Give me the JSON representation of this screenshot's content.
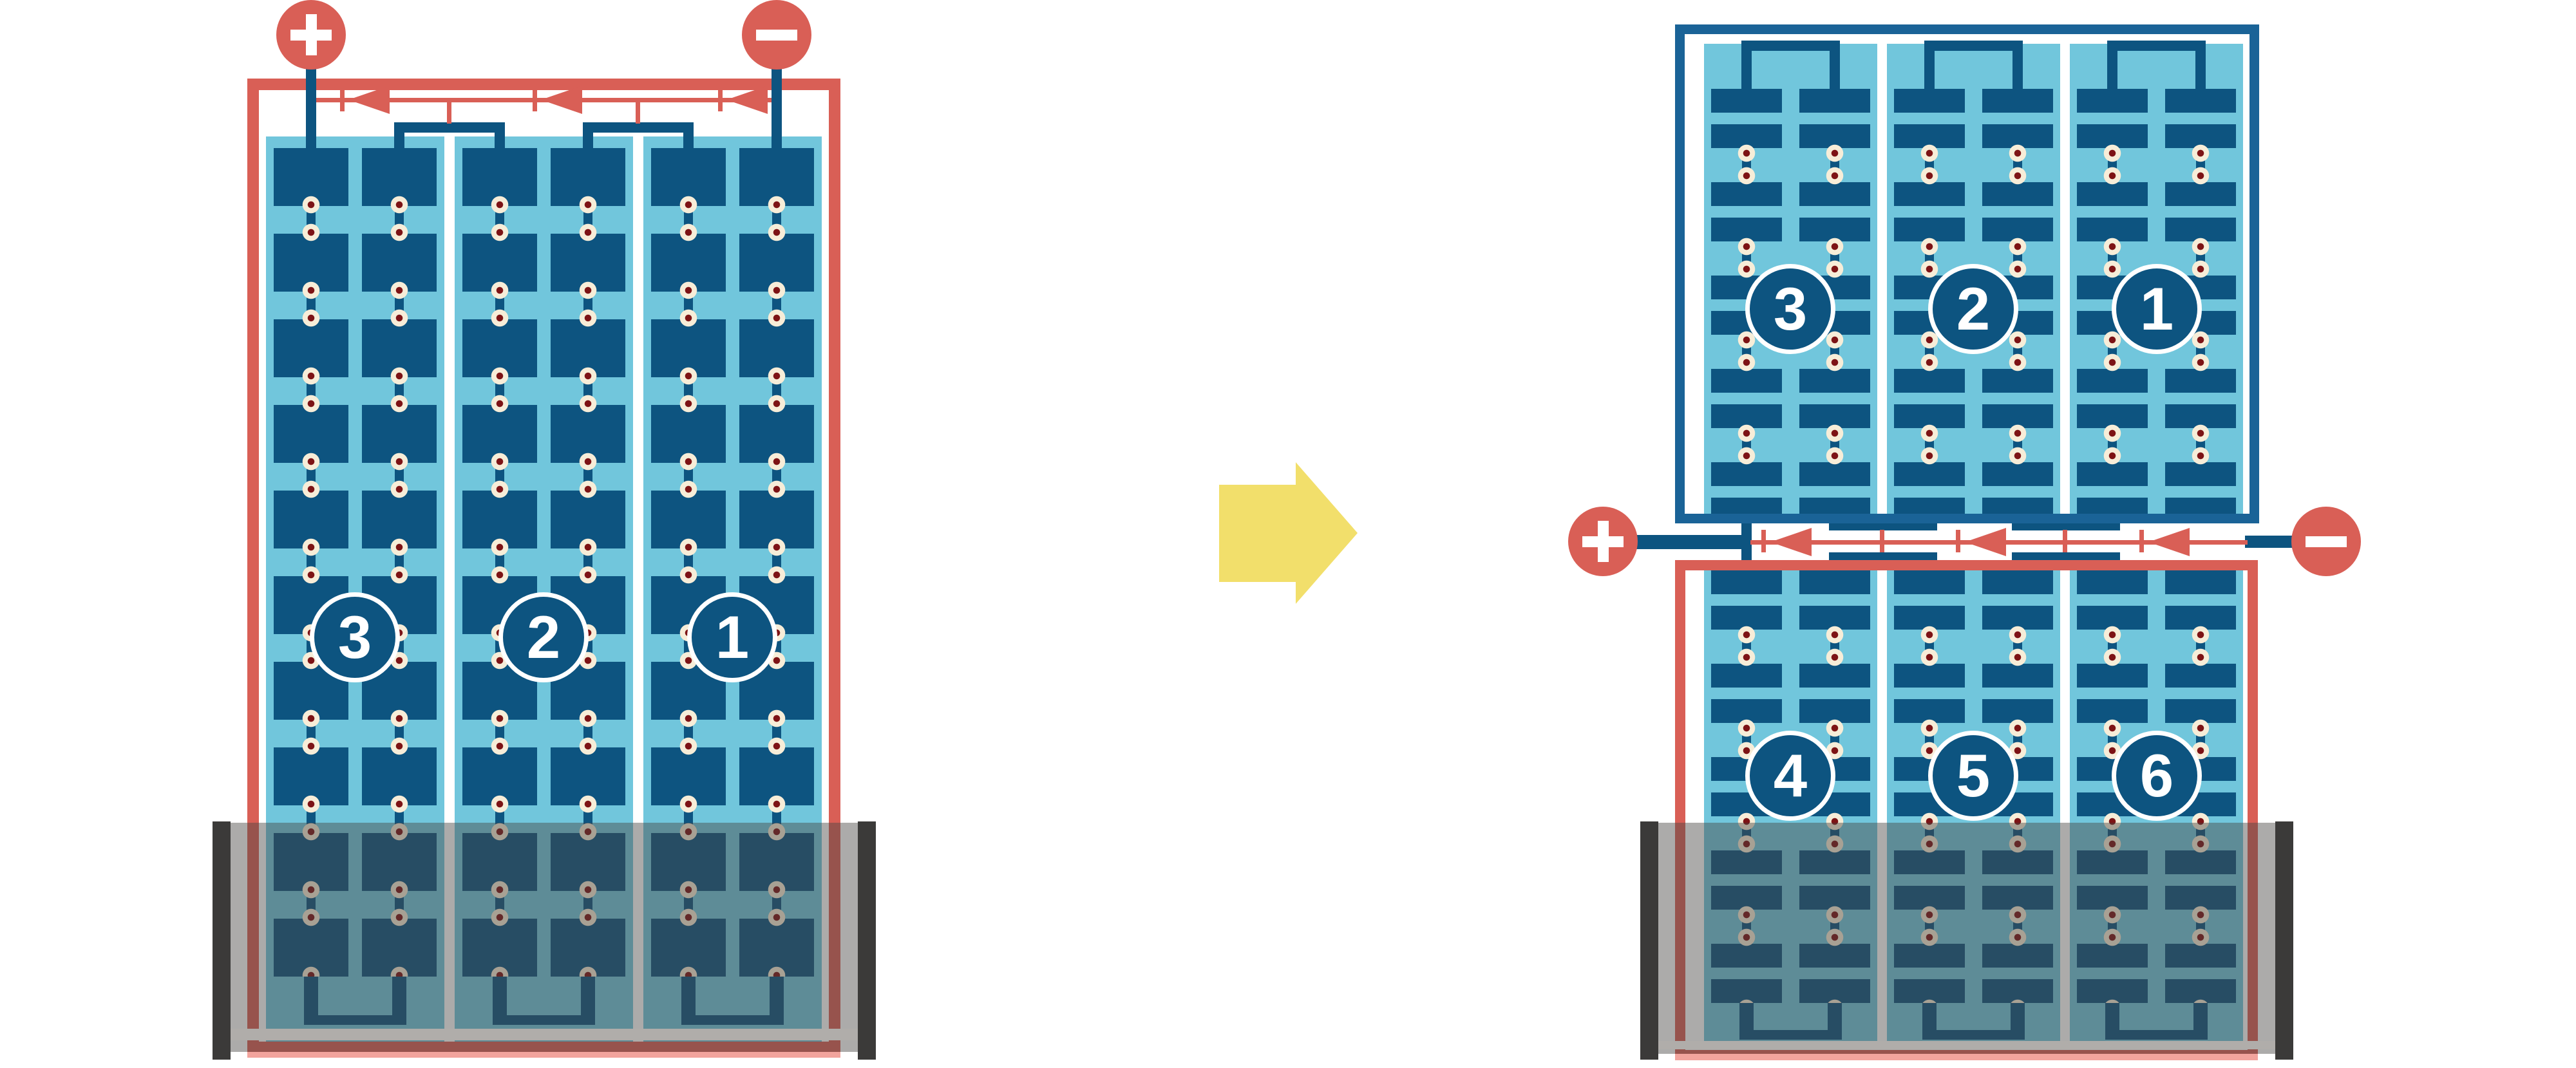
{
  "left_unit": {
    "terminals": {
      "plus": "+",
      "minus": "−"
    },
    "cells": [
      "3",
      "2",
      "1"
    ]
  },
  "right_unit": {
    "terminals": {
      "plus": "+",
      "minus": "−"
    },
    "top_cells": [
      "3",
      "2",
      "1"
    ],
    "bottom_cells": [
      "4",
      "5",
      "6"
    ]
  },
  "transform_arrow": {
    "glyph": "➡",
    "direction": "right"
  },
  "colors": {
    "red": "#D95F56",
    "plate_blue": "#0D5480",
    "frame_blue": "#1A6397",
    "light_blue": "#71C6DC",
    "cream": "#F7EDD8",
    "dot_red": "#7D1315",
    "yellow": "#F2DF6B",
    "tray_dark": "#3B3A39",
    "tray_lip": "#B0ADAA"
  }
}
